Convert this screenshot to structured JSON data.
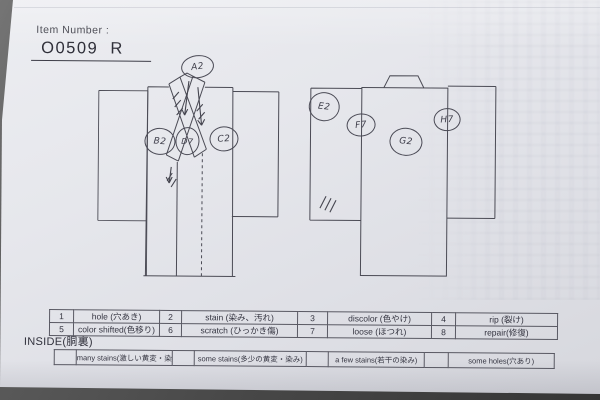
{
  "header": {
    "label": "Item Number :",
    "item_number": "O0509  R"
  },
  "annotations": {
    "front": [
      {
        "text": "A2"
      },
      {
        "text": "B2"
      },
      {
        "text": "C2"
      },
      {
        "text": "D7"
      }
    ],
    "back": [
      {
        "text": "E2"
      },
      {
        "text": "F7"
      },
      {
        "text": "G2"
      },
      {
        "text": "H7"
      }
    ]
  },
  "legend_table": {
    "rows": [
      [
        {
          "num": "1",
          "label": "hole (穴あき)"
        },
        {
          "num": "2",
          "label": "stain (染み、汚れ)"
        },
        {
          "num": "3",
          "label": "discolor (色やけ)"
        },
        {
          "num": "4",
          "label": "rip (裂け)"
        }
      ],
      [
        {
          "num": "5",
          "label": "color shifted(色移り)"
        },
        {
          "num": "6",
          "label": "scratch (ひっかき傷)"
        },
        {
          "num": "7",
          "label": "loose (ほつれ)"
        },
        {
          "num": "8",
          "label": "repair(修復)"
        }
      ]
    ]
  },
  "inside_section": {
    "title": "INSIDE(胴裏)",
    "options": [
      {
        "label": "many stains(激しい黄変・染み)"
      },
      {
        "label": "some stains(多少の黄変・染み)"
      },
      {
        "label": "a few stains(若干の染み)"
      },
      {
        "label": "some holes(穴あり)"
      }
    ]
  },
  "colors": {
    "paper": "#e6e7ec",
    "surface": "#474747",
    "print_line": "#4b4b55",
    "pen": "#45454f"
  }
}
